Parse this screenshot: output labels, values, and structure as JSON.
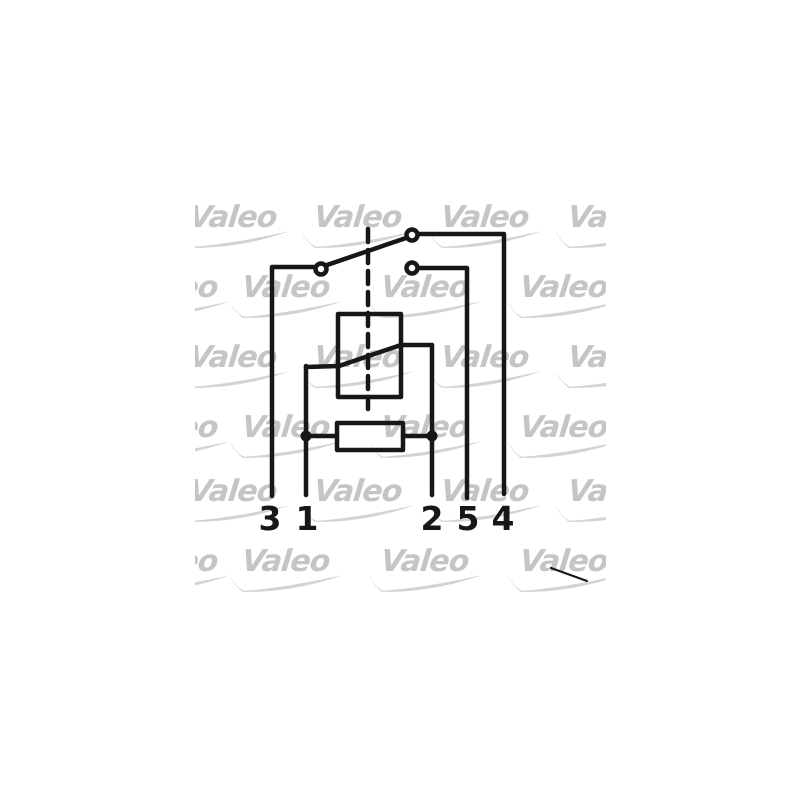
{
  "page": {
    "background_color": "#ffffff",
    "description": "Scanned Valeo relay wiring diagram"
  },
  "watermark": {
    "text": "Valeo",
    "text_color": "#c5c5c5",
    "swoosh_color": "#d3d3d3"
  },
  "diagram": {
    "ink_color": "#171717",
    "terminals": [
      {
        "label": "3"
      },
      {
        "label": "1"
      },
      {
        "label": "2"
      },
      {
        "label": "5"
      },
      {
        "label": "4"
      }
    ]
  }
}
